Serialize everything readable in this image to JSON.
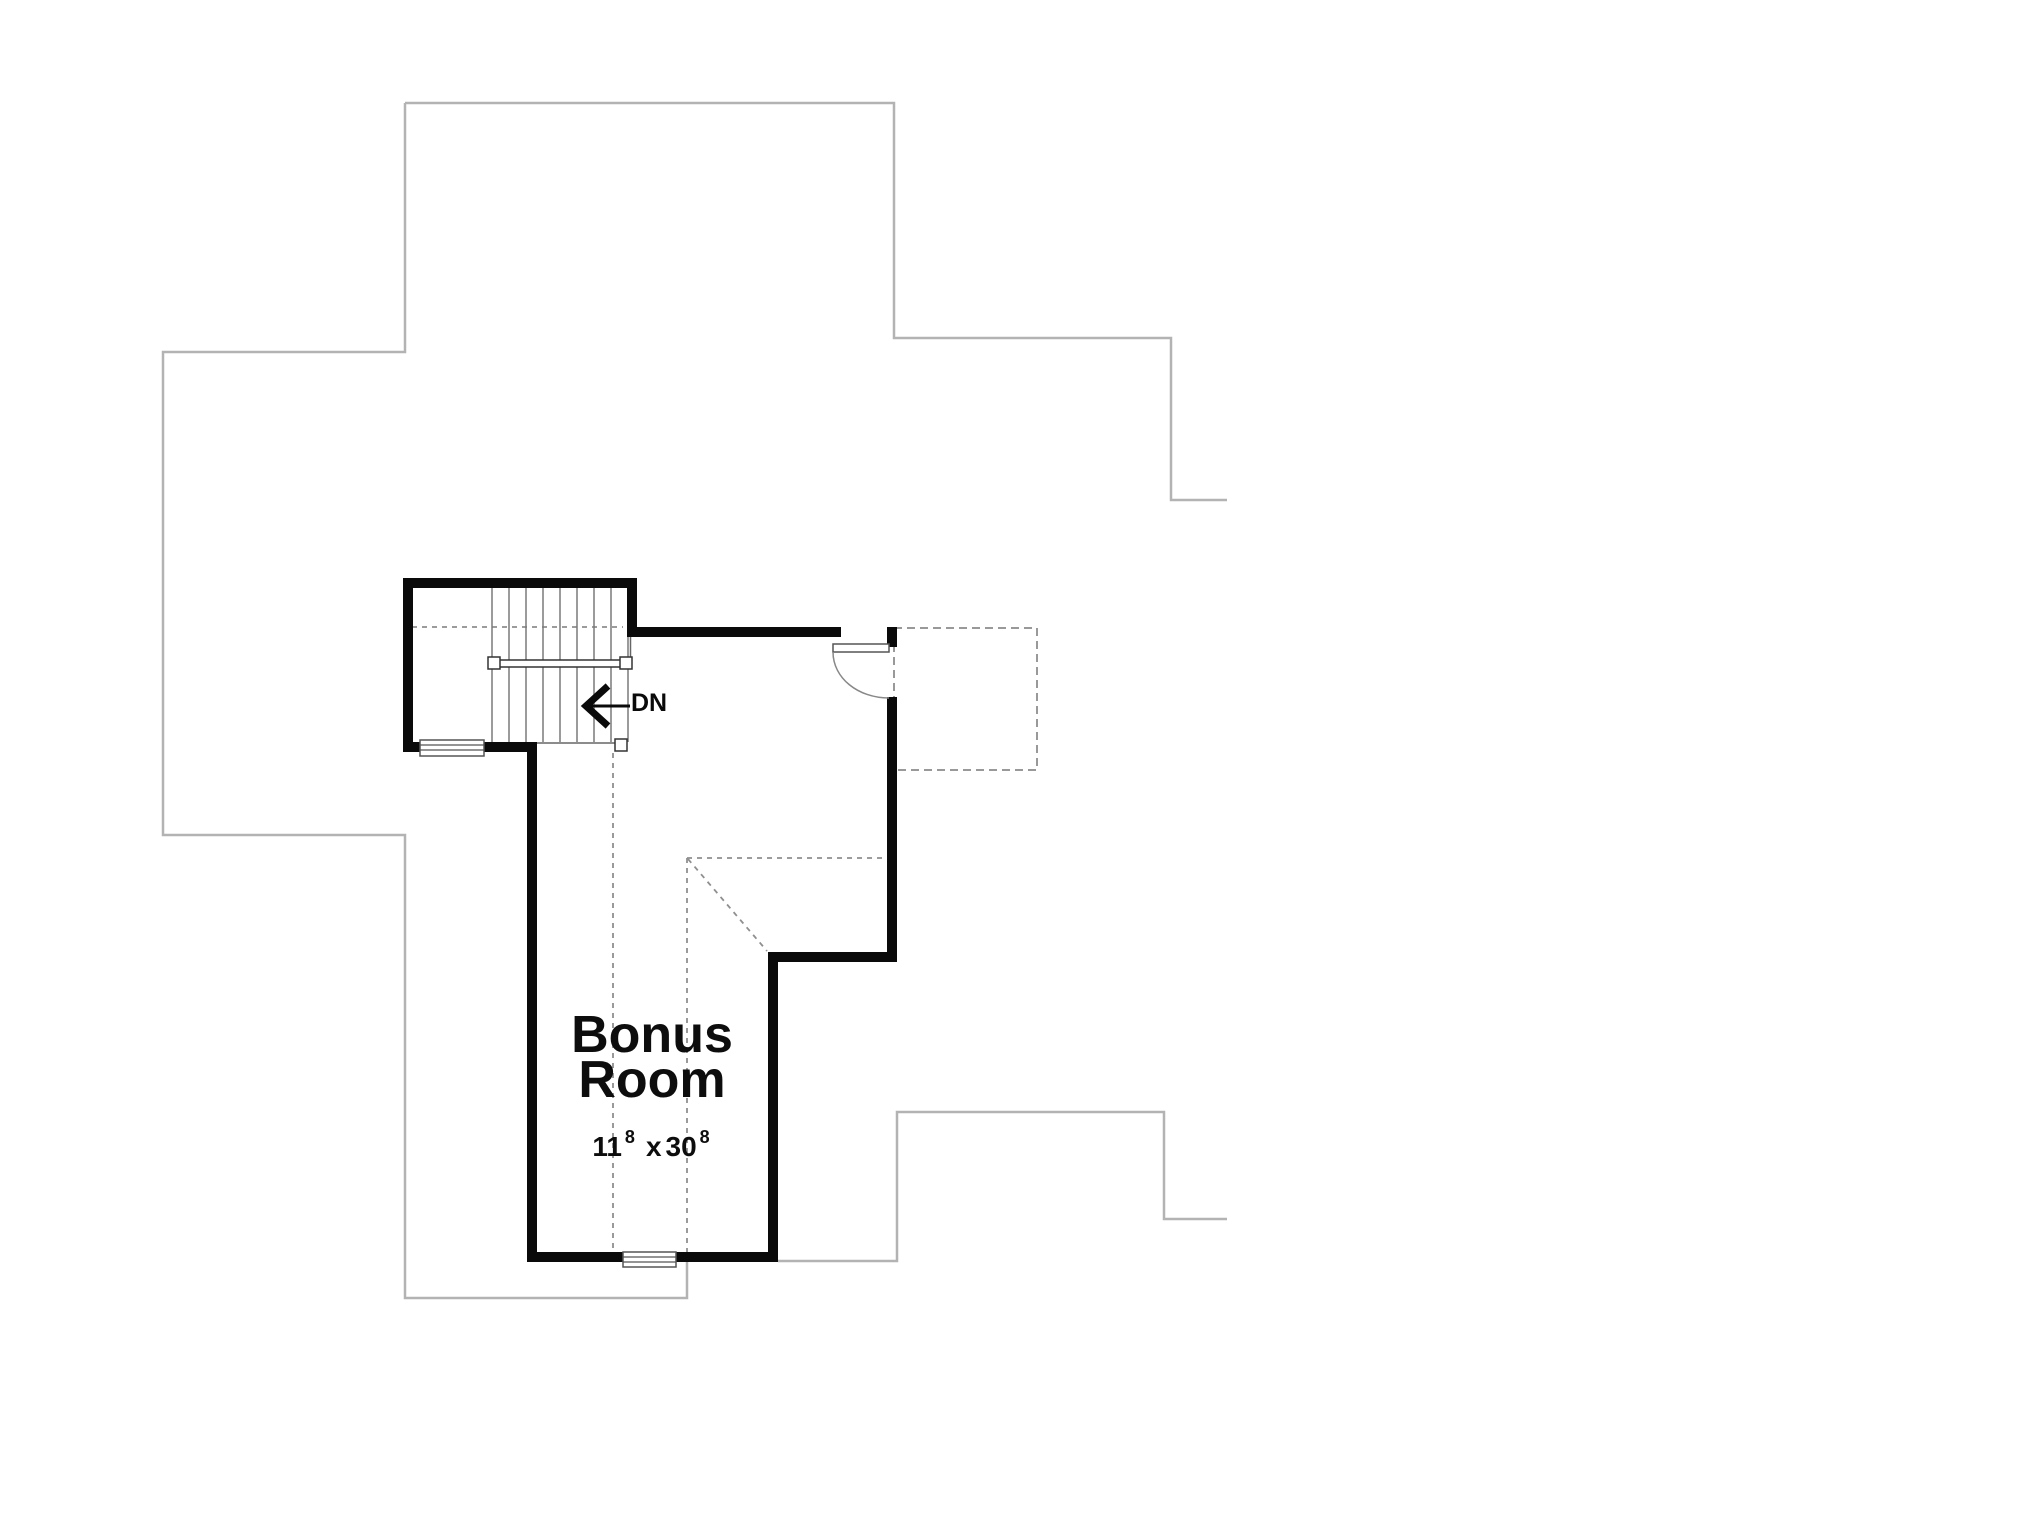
{
  "floor_plan": {
    "stairs": {
      "direction_label": "DN"
    },
    "room": {
      "name_line1": "Bonus",
      "name_line2": "Room",
      "dimensions": {
        "width_feet": "11",
        "width_inches_sup": "8",
        "separator": "x",
        "depth_feet": "30",
        "depth_inches_sup": "8"
      }
    },
    "colors": {
      "wall": "#0a0a0a",
      "roof_outline": "#b3b3b3",
      "hidden_line": "#8f8f8f",
      "stair_tread": "#7a7a7a",
      "background": "#ffffff"
    }
  }
}
